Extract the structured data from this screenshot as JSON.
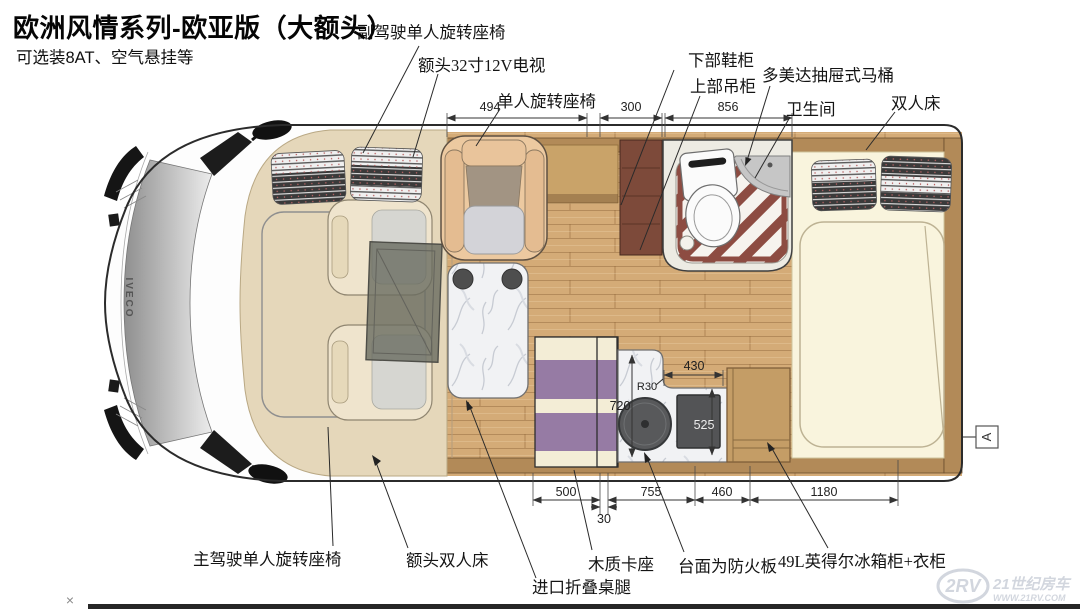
{
  "header": {
    "title": "欧洲风情系列-欧亚版（大额头）",
    "subtitle": "可选装8AT、空气悬挂等"
  },
  "callouts": {
    "co_driver_seat": "副驾驶单人旋转座椅",
    "overhead_tv": "额头32寸12V电视",
    "single_swivel_seat": "单人旋转座椅",
    "lower_shoe_cabinet": "下部鞋柜",
    "upper_wall_cabinet": "上部吊柜",
    "toilet": "多美达抽屉式马桶",
    "bathroom": "卫生间",
    "rear_double_bed": "双人床",
    "driver_seat": "主驾驶单人旋转座椅",
    "overcab_double_bed": "额头双人床",
    "folding_table_legs": "进口折叠桌腿",
    "wooden_dinette": "木质卡座",
    "fireproof_countertop": "台面为防火板",
    "fridge_wardrobe": "49L英得尔冰箱柜+衣柜"
  },
  "dimensions": {
    "swivel_seat_zone": "494",
    "shoe_cabinet_width": "300",
    "bathroom_width": "856",
    "dinette_width": "500",
    "aisle_gap": "30",
    "kitchen_width": "755",
    "fridge_width": "460",
    "bed_length": "1180",
    "counter_section": "430",
    "stove_depth": "525",
    "counter_depth": "720",
    "corner_radius": "R30"
  },
  "markers": {
    "section_label": "A",
    "close_mark": "×"
  },
  "vehicle": {
    "brand": "IVECO"
  },
  "watermark": {
    "logo": "2RV",
    "site_name": "21世纪房车",
    "site_url": "WWW.21RV.COM"
  },
  "colors": {
    "floor_wood": "#d4ab77",
    "wall_wood": "#b28a58",
    "shoe_cabinet": "#7d4a3a",
    "dinette_purple": "#967ba4",
    "bed_cream": "#f9f4dd",
    "shower_stripe": "#8d4c42",
    "marble": "#f1f2f4",
    "appliance_dark": "#58595b"
  }
}
